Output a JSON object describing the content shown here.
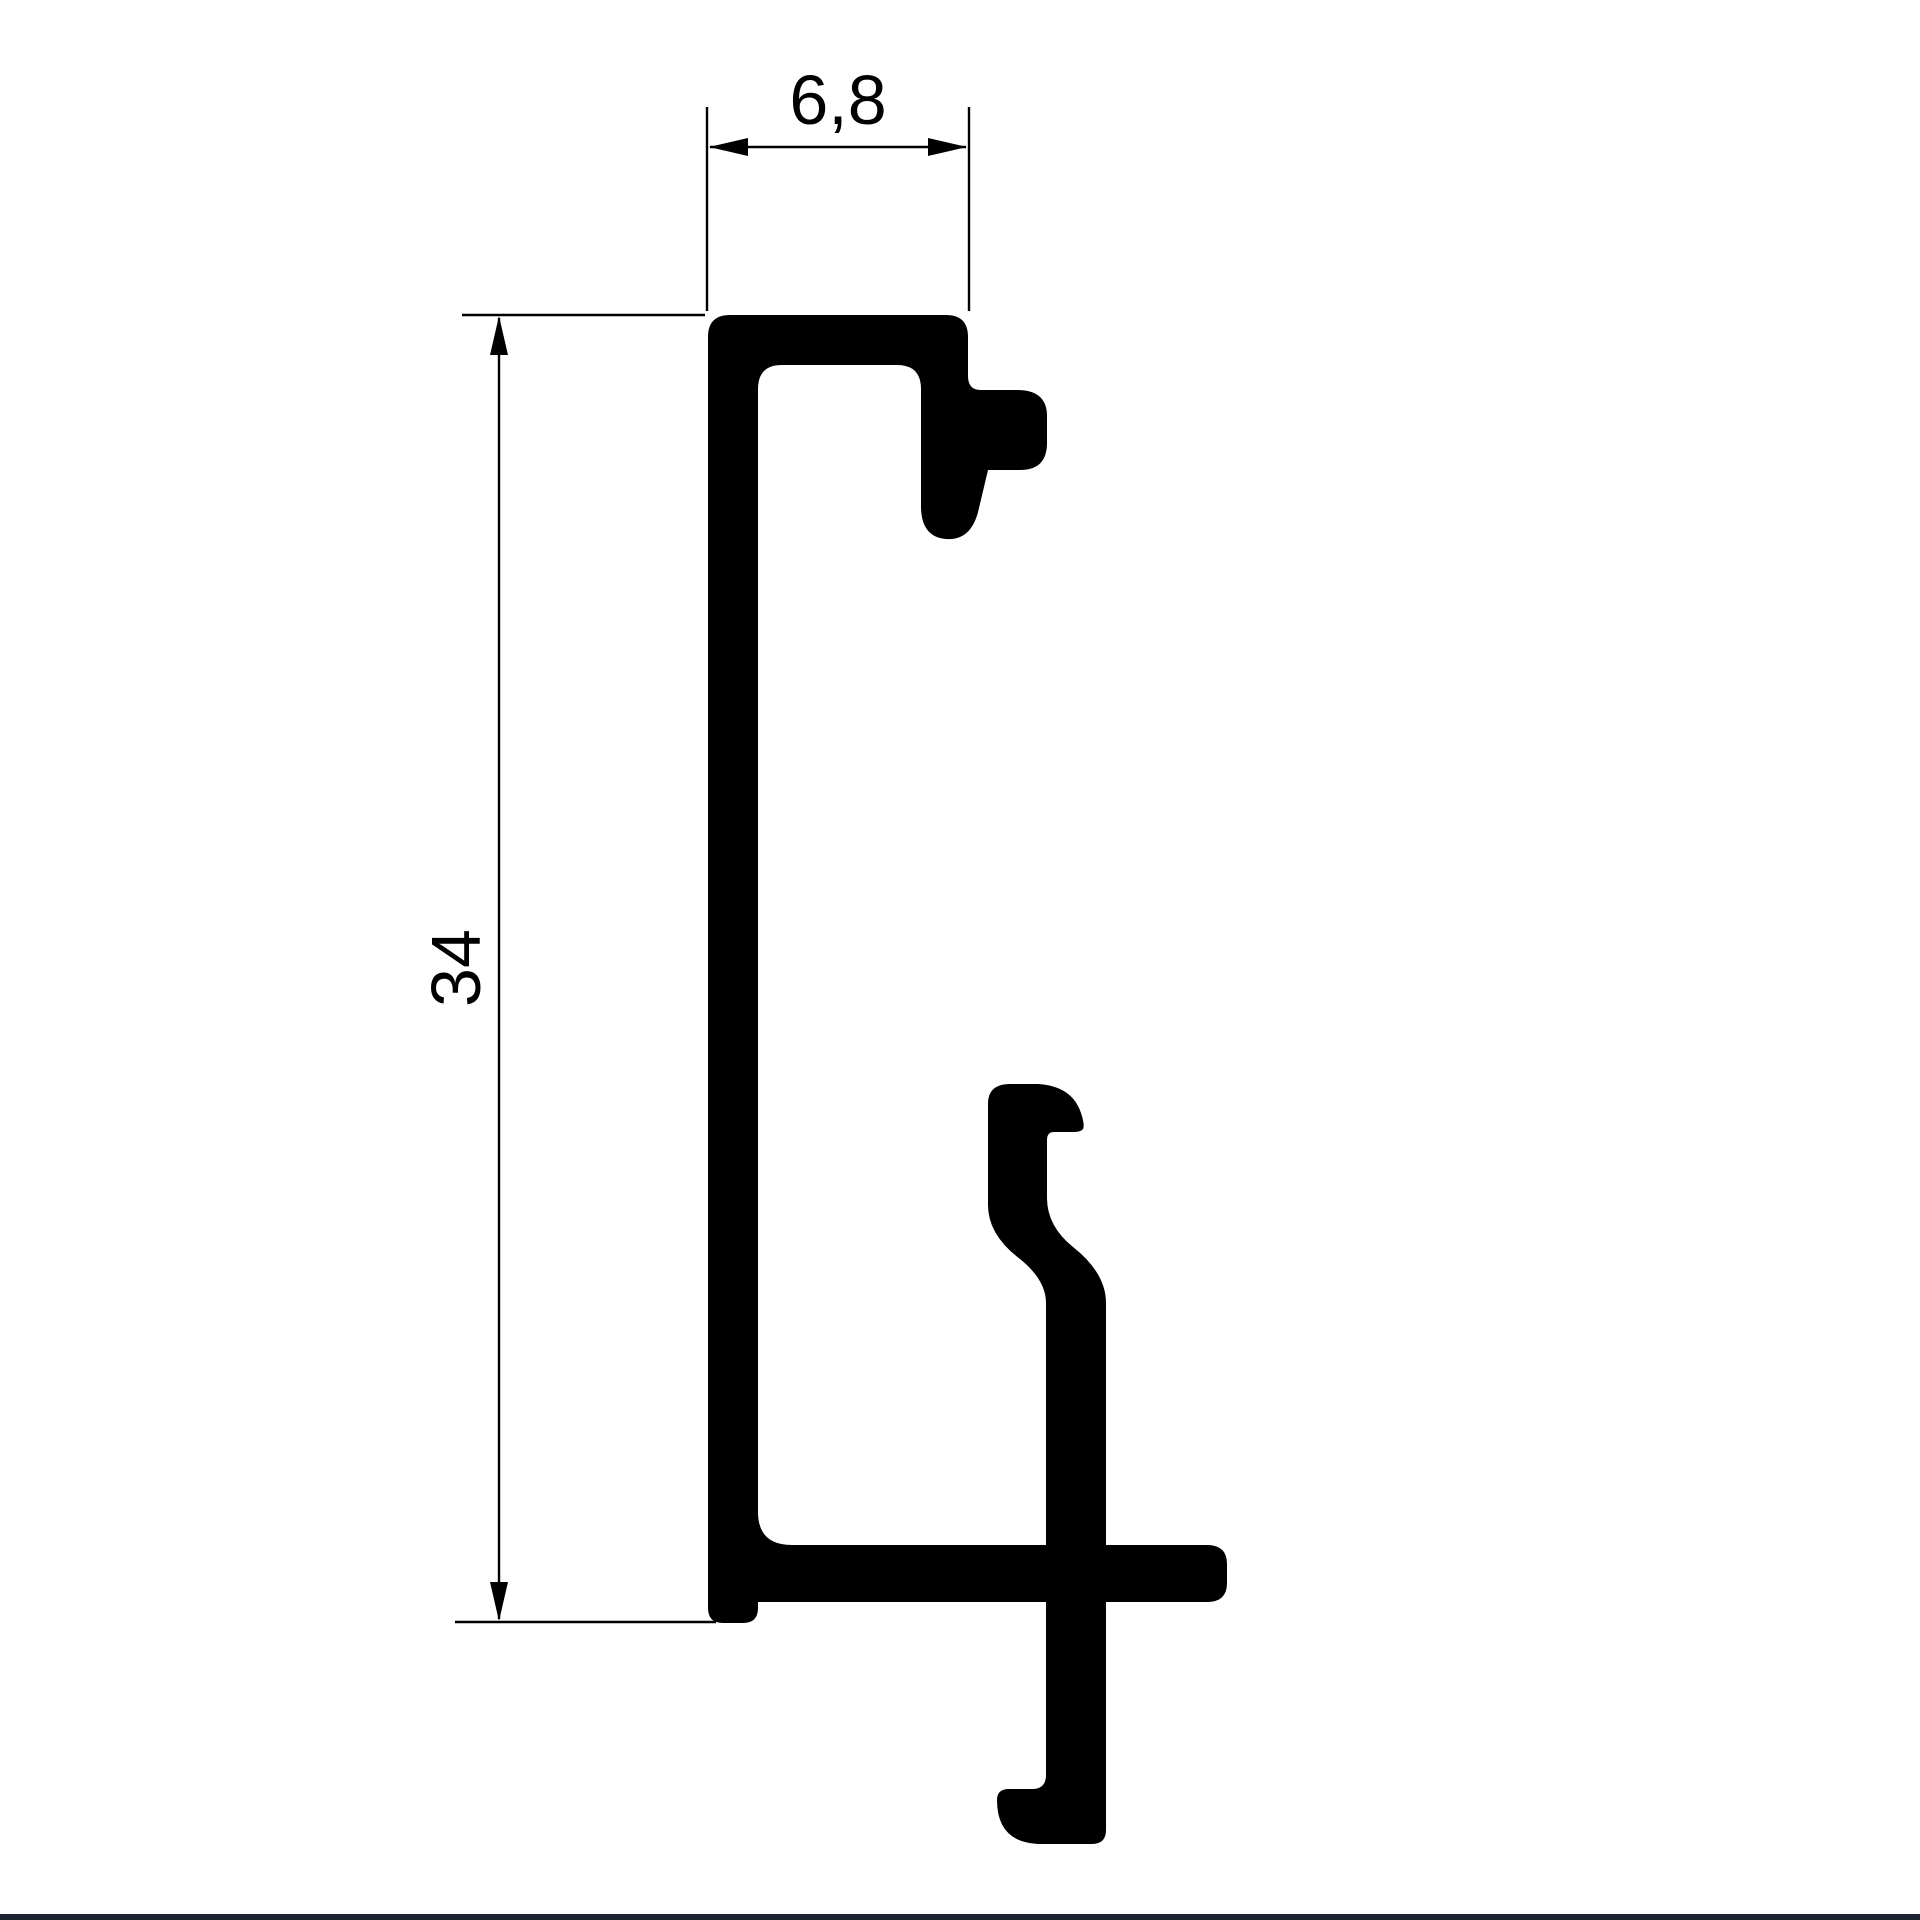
{
  "drawing": {
    "type": "technical-cross-section",
    "dimensions": {
      "width_label": "6,8",
      "height_label": "34"
    },
    "colors": {
      "background": "#ffffff",
      "ink": "#000000",
      "footer_bar": "#1c2430"
    }
  }
}
